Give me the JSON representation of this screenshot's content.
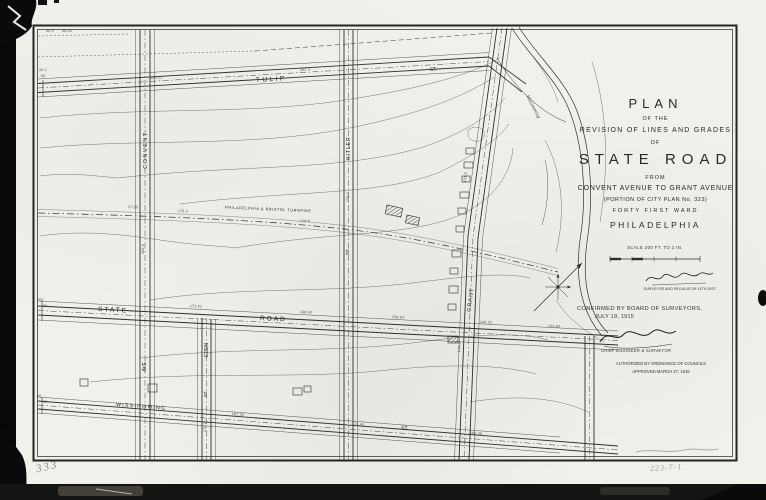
{
  "title_block": {
    "l1": "PLAN",
    "l2": "OF THE",
    "l3": "REVISION OF LINES AND GRADES",
    "l4": "OF",
    "l5": "STATE ROAD",
    "l6": "FROM",
    "l7": "CONVENT AVENUE TO GRANT AVENUE",
    "l8": "(PORTION OF CITY PLAN No. 323)",
    "l9": "FORTY FIRST WARD",
    "l10": "PHILADELPHIA"
  },
  "scale": {
    "label": "SCALE 200 FT. TO 1 IN."
  },
  "certification": {
    "confirmed1": "CONFIRMED BY BOARD OF SURVEYORS,",
    "confirmed2": "JULY 19, 1915",
    "sig1_caption": "SURVEYOR AND REGULATOR 14TH DIST.",
    "sig2_caption": "CHIEF ENGINEER & SURVEYOR",
    "authorized1": "AUTHORIZED BY ORDINANCE OF COUNCILS",
    "authorized2": "APPROVED MARCH 27, 1915"
  },
  "streets": {
    "tulip": {
      "name": "TULIP",
      "suffix": "ST."
    },
    "state": {
      "name": "STATE",
      "suffix": "ROAD"
    },
    "wissinoming": {
      "name": "WISSINOMING",
      "suffix": "ST."
    },
    "convent": {
      "name": "CONVENT",
      "suffix": "AVE."
    },
    "eden": {
      "name": "EDEN",
      "suffix": "ST."
    },
    "kitler": {
      "name": "KITLER",
      "suffix": "ST."
    },
    "grant": {
      "name": "GRANT"
    }
  },
  "old_road_label": "PHILADELPHIA & BRISTOL TURNPIKE",
  "creek_label": "Wissinoming",
  "pencil": {
    "bottom_left": "333",
    "bottom_right": "223-7-1"
  },
  "grade_marks": [
    {
      "t": "30.2",
      "x": 39,
      "y": 68,
      "r": 0
    },
    {
      "t": "50",
      "x": 41,
      "y": 74,
      "r": 0
    },
    {
      "t": "30.0",
      "x": 46,
      "y": 29,
      "r": 0
    },
    {
      "t": "38.43",
      "x": 62,
      "y": 29,
      "r": 0
    },
    {
      "t": "166.21",
      "x": 150,
      "y": 76,
      "r": -3
    },
    {
      "t": "162.4",
      "x": 300,
      "y": 68,
      "r": -3
    },
    {
      "t": "17.58",
      "x": 128,
      "y": 205,
      "r": 2
    },
    {
      "t": "175.3",
      "x": 178,
      "y": 209,
      "r": 2
    },
    {
      "t": "170.6",
      "x": 300,
      "y": 219,
      "r": 2
    },
    {
      "t": "173.52",
      "x": 190,
      "y": 304,
      "r": 3
    },
    {
      "t": "168.40",
      "x": 300,
      "y": 310,
      "r": 3
    },
    {
      "t": "158.64",
      "x": 392,
      "y": 315,
      "r": 3
    },
    {
      "t": "146.22",
      "x": 480,
      "y": 320,
      "r": 3
    },
    {
      "t": "134.80",
      "x": 548,
      "y": 324,
      "r": 3
    },
    {
      "t": "202",
      "x": 37,
      "y": 298,
      "r": 0
    },
    {
      "t": "50",
      "x": 43,
      "y": 304,
      "r": 0
    },
    {
      "t": "181.20",
      "x": 232,
      "y": 412,
      "r": 4
    },
    {
      "t": "173.45",
      "x": 352,
      "y": 422,
      "r": 4
    },
    {
      "t": "166.38",
      "x": 470,
      "y": 431,
      "r": 4
    },
    {
      "t": "60",
      "x": 37,
      "y": 394,
      "r": 0
    },
    {
      "t": "50",
      "x": 43,
      "y": 400,
      "r": 0
    },
    {
      "t": "183.6",
      "x": 141,
      "y": 254,
      "r": -90
    },
    {
      "t": "176.2",
      "x": 203,
      "y": 432,
      "r": -90
    },
    {
      "t": "158.3",
      "x": 346,
      "y": 202,
      "r": -90
    },
    {
      "t": "131.5",
      "x": 463,
      "y": 182,
      "r": -86
    },
    {
      "t": "126.0",
      "x": 457,
      "y": 352,
      "r": -86
    }
  ],
  "colors": {
    "paper": "#f1f0ea",
    "ink": "#2f2d2a",
    "contour": "#75736d",
    "scan_bg": "#070707",
    "pencil": "#8b8a83"
  }
}
